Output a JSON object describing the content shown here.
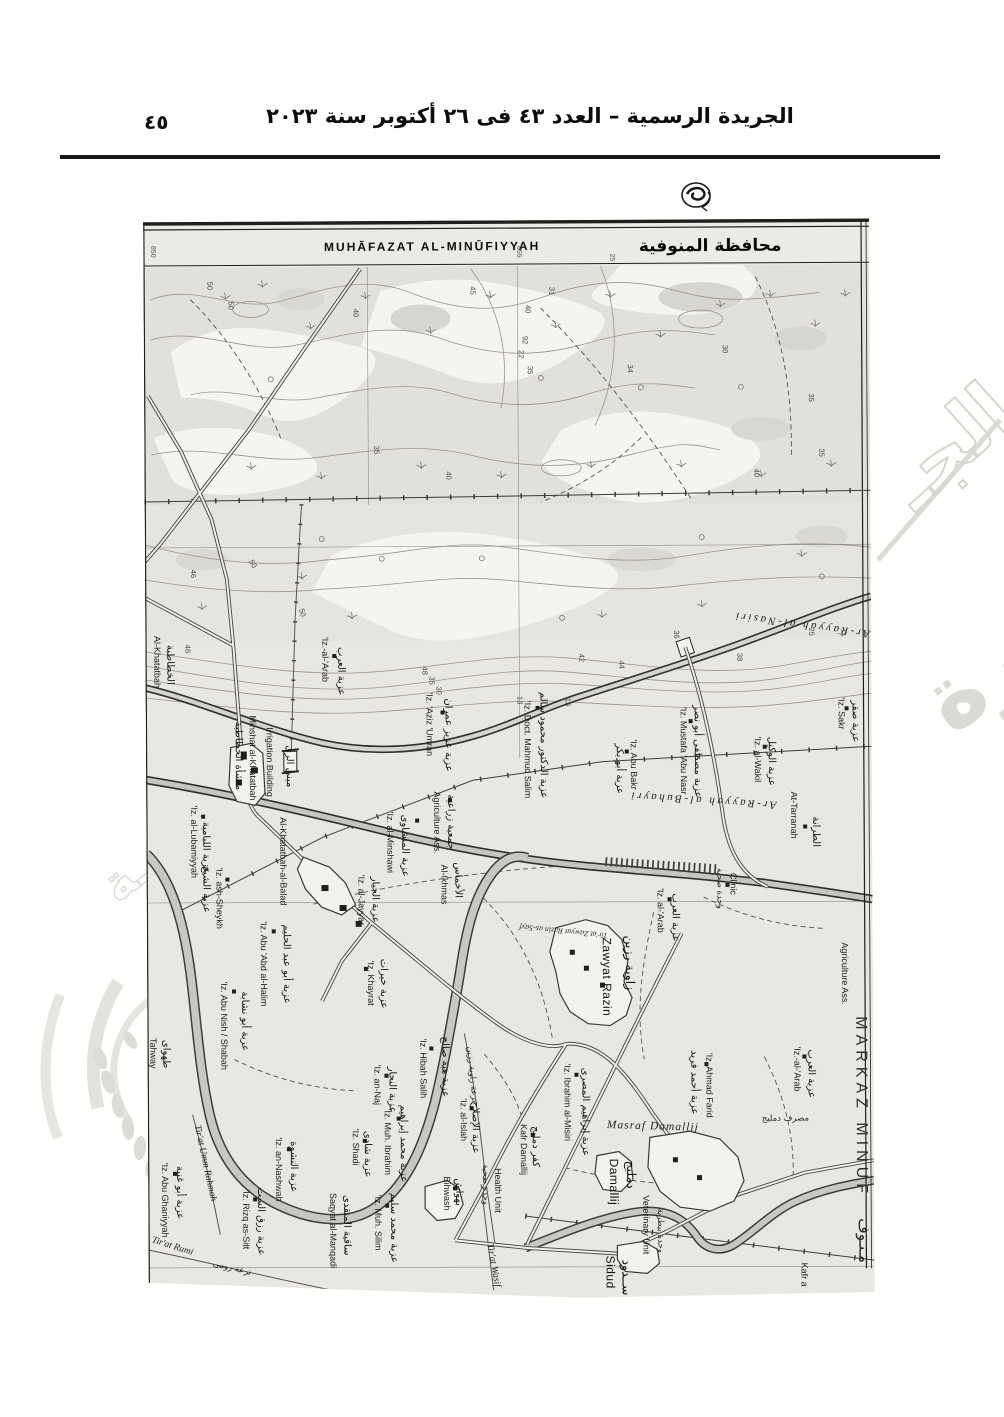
{
  "header": {
    "page_number": "٤٥",
    "gazette_title": "الجريدة الرسمية – العدد ٤٣ فى ٢٦ أكتوبر سنة ٢٠٢٣"
  },
  "map": {
    "title_latin": "MUHĀFAZAT AL-MINŪFIYYAH",
    "title_arabic": "محافظة المنوفية",
    "labels": [
      {
        "t": "850",
        "x": 151,
        "y": 246,
        "r": 90,
        "c": "grid"
      },
      {
        "t": "855",
        "x": 517,
        "y": 248,
        "r": 90,
        "c": "grid"
      },
      {
        "t": "25",
        "x": 610,
        "y": 256,
        "r": 90,
        "c": "grid"
      },
      {
        "t": "50",
        "x": 207,
        "y": 282,
        "r": 90,
        "c": "num"
      },
      {
        "t": "50",
        "x": 228,
        "y": 302,
        "r": 90,
        "c": "num"
      },
      {
        "t": "40",
        "x": 353,
        "y": 310,
        "r": 90,
        "c": "num"
      },
      {
        "t": "35",
        "x": 373,
        "y": 447,
        "r": 90,
        "c": "num"
      },
      {
        "t": "40",
        "x": 445,
        "y": 473,
        "r": 90,
        "c": "num"
      },
      {
        "t": "45",
        "x": 470,
        "y": 288,
        "r": 90,
        "c": "num"
      },
      {
        "t": "40",
        "x": 525,
        "y": 307,
        "r": 90,
        "c": "num"
      },
      {
        "t": "31",
        "x": 549,
        "y": 289,
        "r": 90,
        "c": "num"
      },
      {
        "t": "92",
        "x": 522,
        "y": 338,
        "r": 90,
        "c": "num"
      },
      {
        "t": "22",
        "x": 518,
        "y": 352,
        "r": 90,
        "c": "num"
      },
      {
        "t": "35",
        "x": 527,
        "y": 368,
        "r": 90,
        "c": "num"
      },
      {
        "t": "30",
        "x": 722,
        "y": 348,
        "r": 90,
        "c": "num"
      },
      {
        "t": "34",
        "x": 627,
        "y": 367,
        "r": 90,
        "c": "num"
      },
      {
        "t": "35",
        "x": 808,
        "y": 397,
        "r": 90,
        "c": "num"
      },
      {
        "t": "40",
        "x": 753,
        "y": 472,
        "r": 90,
        "c": "num"
      },
      {
        "t": "35",
        "x": 818,
        "y": 452,
        "r": 90,
        "c": "num"
      },
      {
        "t": "46",
        "x": 189,
        "y": 570,
        "r": 90,
        "c": "num"
      },
      {
        "t": "50",
        "x": 247,
        "y": 562,
        "r": 60,
        "c": "num"
      },
      {
        "t": "50",
        "x": 297,
        "y": 610,
        "r": 75,
        "c": "num"
      },
      {
        "t": "46",
        "x": 183,
        "y": 645,
        "r": 90,
        "c": "num"
      },
      {
        "t": "48",
        "x": 420,
        "y": 668,
        "r": 90,
        "c": "num"
      },
      {
        "t": "35",
        "x": 427,
        "y": 678,
        "r": 90,
        "c": "num"
      },
      {
        "t": "30",
        "x": 434,
        "y": 688,
        "r": 90,
        "c": "num"
      },
      {
        "t": "36",
        "x": 672,
        "y": 633,
        "r": 90,
        "c": "num"
      },
      {
        "t": "25",
        "x": 807,
        "y": 631,
        "r": 90,
        "c": "num"
      },
      {
        "t": "38",
        "x": 735,
        "y": 656,
        "r": 90,
        "c": "num"
      },
      {
        "t": "42",
        "x": 577,
        "y": 656,
        "r": 90,
        "c": "num"
      },
      {
        "t": "44",
        "x": 617,
        "y": 663,
        "r": 90,
        "c": "num"
      },
      {
        "t": "13",
        "x": 515,
        "y": 698,
        "r": 90,
        "c": "num"
      },
      {
        "t": "13",
        "x": 563,
        "y": 700,
        "r": 90,
        "c": "num"
      },
      {
        "t": "Al-Khatatbah",
        "x": 152,
        "y": 636,
        "r": 90,
        "c": "en"
      },
      {
        "t": "الخطاطبة",
        "x": 165,
        "y": 645,
        "r": 90,
        "c": "ar"
      },
      {
        "t": "Minshat al-Khatatbah",
        "x": 247,
        "y": 716,
        "r": 90,
        "c": "en"
      },
      {
        "t": "منشأة الخطاطبة",
        "x": 233,
        "y": 722,
        "r": 90,
        "c": "ar"
      },
      {
        "t": "Irrigation Building",
        "x": 264,
        "y": 728,
        "r": 90,
        "c": "en"
      },
      {
        "t": "مبنى الرى",
        "x": 284,
        "y": 746,
        "r": 90,
        "c": "ar"
      },
      {
        "t": "'Iz.-al-'Arab",
        "x": 320,
        "y": 638,
        "r": 90,
        "c": "en"
      },
      {
        "t": "عزبة العرب",
        "x": 336,
        "y": 648,
        "r": 90,
        "c": "ar"
      },
      {
        "t": "'Iz. 'Aziz 'Umran",
        "x": 424,
        "y": 694,
        "r": 90,
        "c": "en"
      },
      {
        "t": "عزبة عزيز عمران",
        "x": 443,
        "y": 700,
        "r": 90,
        "c": "ar"
      },
      {
        "t": "'Iz. Doct. Mahmud Salim",
        "x": 522,
        "y": 703,
        "r": 90,
        "c": "en"
      },
      {
        "t": "عزبة الدكتور محمود سالم",
        "x": 538,
        "y": 694,
        "r": 90,
        "c": "ar"
      },
      {
        "t": "'Iz. Abu Bakr",
        "x": 628,
        "y": 742,
        "r": 90,
        "c": "en"
      },
      {
        "t": "عزبة أبو بكر",
        "x": 614,
        "y": 746,
        "r": 90,
        "c": "ar"
      },
      {
        "t": "'Iz. Mustafa 'Abu Nasr",
        "x": 678,
        "y": 710,
        "r": 90,
        "c": "en"
      },
      {
        "t": "عزبة مصطفى أبو نصر",
        "x": 692,
        "y": 708,
        "r": 90,
        "c": "ar"
      },
      {
        "t": "'Iz. al-Wakil",
        "x": 752,
        "y": 740,
        "r": 90,
        "c": "en"
      },
      {
        "t": "عزبة الوكيل",
        "x": 766,
        "y": 740,
        "r": 90,
        "c": "ar"
      },
      {
        "t": "'Iz. Sakr",
        "x": 836,
        "y": 701,
        "r": 90,
        "c": "en"
      },
      {
        "t": "عزبة صقر",
        "x": 850,
        "y": 704,
        "r": 90,
        "c": "ar"
      },
      {
        "t": "Ar-Rayyah al-Nasiri",
        "x": 800,
        "y": 625,
        "r": 188,
        "c": "canal",
        "a": "middle"
      },
      {
        "t": "Ar-Rayyah al-Buhayri",
        "x": 700,
        "y": 800,
        "r": 184,
        "c": "canal",
        "a": "middle"
      },
      {
        "t": "At-Tarranah",
        "x": 788,
        "y": 795,
        "r": 90,
        "c": "en"
      },
      {
        "t": "الطرانة",
        "x": 810,
        "y": 820,
        "r": 90,
        "c": "ar"
      },
      {
        "t": "Clinic",
        "x": 727,
        "y": 876,
        "r": 90,
        "c": "en"
      },
      {
        "t": "وحدة صحية",
        "x": 714,
        "y": 871,
        "r": 90,
        "c": "ar-sm"
      },
      {
        "t": "'Iz. al-'Arab",
        "x": 654,
        "y": 891,
        "r": 90,
        "c": "en"
      },
      {
        "t": "عزبة العرب",
        "x": 669,
        "y": 896,
        "r": 90,
        "c": "ar"
      },
      {
        "t": "Zawyat Razin",
        "x": 599,
        "y": 940,
        "r": 90,
        "c": "en-lg"
      },
      {
        "t": "زاوية رزين",
        "x": 622,
        "y": 938,
        "r": 90,
        "c": "ar-lg"
      },
      {
        "t": "'Iz. Ahmad Farid",
        "x": 702,
        "y": 1056,
        "r": 90,
        "c": "en"
      },
      {
        "t": "عزبة أحمد فريد",
        "x": 687,
        "y": 1053,
        "r": 90,
        "c": "ar"
      },
      {
        "t": "'Iz.-al-'Arab",
        "x": 790,
        "y": 1050,
        "r": 90,
        "c": "en"
      },
      {
        "t": "عزبة العرب",
        "x": 804,
        "y": 1053,
        "r": 90,
        "c": "ar"
      },
      {
        "t": "Agriculture Ass.",
        "x": 838,
        "y": 946,
        "r": 90,
        "c": "en"
      },
      {
        "t": "MARKAZ MINUF",
        "x": 852,
        "y": 1020,
        "r": 90,
        "c": "big"
      },
      {
        "t": "مـنـوف",
        "x": 854,
        "y": 1222,
        "r": 90,
        "c": "big-ar"
      },
      {
        "t": "Kafr a",
        "x": 796,
        "y": 1266,
        "r": 90,
        "c": "en"
      },
      {
        "t": "Agriculture Ass.",
        "x": 431,
        "y": 793,
        "r": 90,
        "c": "en"
      },
      {
        "t": "جمعية زراعية",
        "x": 445,
        "y": 796,
        "r": 90,
        "c": "ar"
      },
      {
        "t": "'Iz. al-Minshawi",
        "x": 384,
        "y": 813,
        "r": 90,
        "c": "en"
      },
      {
        "t": "عزبة المنشاوى",
        "x": 399,
        "y": 816,
        "r": 90,
        "c": "ar"
      },
      {
        "t": "Al-Ikhmas",
        "x": 438,
        "y": 866,
        "r": 90,
        "c": "en"
      },
      {
        "t": "الأخماس",
        "x": 452,
        "y": 864,
        "r": 90,
        "c": "ar"
      },
      {
        "t": "'Iz. al-Jayyar",
        "x": 355,
        "y": 876,
        "r": 90,
        "c": "en"
      },
      {
        "t": "عزبة الجيار",
        "x": 369,
        "y": 878,
        "r": 90,
        "c": "ar"
      },
      {
        "t": "Al-Khatatbah-al-Balad",
        "x": 277,
        "y": 818,
        "r": 90,
        "c": "en"
      },
      {
        "t": "'Iz. ash-Sheykh",
        "x": 213,
        "y": 868,
        "r": 90,
        "c": "en"
      },
      {
        "t": "عزبة الشيخ",
        "x": 200,
        "y": 866,
        "r": 90,
        "c": "ar"
      },
      {
        "t": "'Iz. al-Lubamiyyah",
        "x": 188,
        "y": 806,
        "r": 90,
        "c": "en"
      },
      {
        "t": "عزبة اللبامية",
        "x": 200,
        "y": 822,
        "r": 90,
        "c": "ar"
      },
      {
        "t": "'Iz. Abu 'Abd al-Halim",
        "x": 257,
        "y": 922,
        "r": 90,
        "c": "en"
      },
      {
        "t": "عزبة أبو عبد الحليم",
        "x": 280,
        "y": 925,
        "r": 90,
        "c": "ar"
      },
      {
        "t": "'Iz. Abu Nish / Shabah",
        "x": 217,
        "y": 982,
        "r": 90,
        "c": "en"
      },
      {
        "t": "عزبة أبو نشابة",
        "x": 238,
        "y": 992,
        "r": 90,
        "c": "ar"
      },
      {
        "t": "'Iz. Khayrat",
        "x": 364,
        "y": 962,
        "r": 90,
        "c": "en"
      },
      {
        "t": "عزبة خيرات",
        "x": 377,
        "y": 960,
        "r": 90,
        "c": "ar"
      },
      {
        "t": "Tahway",
        "x": 146,
        "y": 1038,
        "r": 90,
        "c": "en"
      },
      {
        "t": "طهواى",
        "x": 159,
        "y": 1040,
        "r": 90,
        "c": "ar"
      },
      {
        "t": "'Iz. Hibah Salih",
        "x": 416,
        "y": 1040,
        "r": 90,
        "c": "en"
      },
      {
        "t": "عزبة هبة صالح",
        "x": 438,
        "y": 1038,
        "r": 90,
        "c": "ar"
      },
      {
        "t": "'Iz. an-Naj",
        "x": 370,
        "y": 1066,
        "r": 90,
        "c": "en"
      },
      {
        "t": "عزبة النجار",
        "x": 385,
        "y": 1068,
        "r": 90,
        "c": "ar"
      },
      {
        "t": "'Iz. Muh. Ibrahim",
        "x": 380,
        "y": 1110,
        "r": 90,
        "c": "en"
      },
      {
        "t": "عزبة محمد إبراهيم",
        "x": 396,
        "y": 1106,
        "r": 90,
        "c": "ar"
      },
      {
        "t": "'Iz. Shadi",
        "x": 348,
        "y": 1130,
        "r": 90,
        "c": "en"
      },
      {
        "t": "عزبة شادى",
        "x": 360,
        "y": 1132,
        "r": 90,
        "c": "ar"
      },
      {
        "t": "'Iz. Muh. Silim",
        "x": 370,
        "y": 1196,
        "r": 90,
        "c": "en"
      },
      {
        "t": "عزبة محمد سليم",
        "x": 386,
        "y": 1194,
        "r": 90,
        "c": "ar"
      },
      {
        "t": "Saqyat al-Manqadi",
        "x": 325,
        "y": 1194,
        "r": 90,
        "c": "en"
      },
      {
        "t": "ساقية المنقدى",
        "x": 339,
        "y": 1196,
        "r": 90,
        "c": "ar"
      },
      {
        "t": "'Iz. Rizq as-Sitt",
        "x": 238,
        "y": 1190,
        "r": 90,
        "c": "en"
      },
      {
        "t": "عزبة رزق الست",
        "x": 253,
        "y": 1188,
        "r": 90,
        "c": "ar"
      },
      {
        "t": "'Iz. Abu Ghaniyyah",
        "x": 157,
        "y": 1163,
        "r": 90,
        "c": "en"
      },
      {
        "t": "عزبة أبو غنية",
        "x": 172,
        "y": 1166,
        "r": 90,
        "c": "ar"
      },
      {
        "t": "'Iz. an-Nashwah",
        "x": 271,
        "y": 1138,
        "r": 90,
        "c": "en"
      },
      {
        "t": "عزبة النشوة",
        "x": 286,
        "y": 1142,
        "r": 90,
        "c": "ar"
      },
      {
        "t": "Bihwash",
        "x": 439,
        "y": 1178,
        "r": 90,
        "c": "en"
      },
      {
        "t": "بهواش",
        "x": 451,
        "y": 1180,
        "r": 90,
        "c": "ar"
      },
      {
        "t": "Health Unit",
        "x": 490,
        "y": 1170,
        "r": 90,
        "c": "en"
      },
      {
        "t": "وحدة صحية",
        "x": 478,
        "y": 1166,
        "r": 90,
        "c": "ar-sm"
      },
      {
        "t": "'Iz. al-Islah",
        "x": 456,
        "y": 1100,
        "r": 90,
        "c": "en"
      },
      {
        "t": "عزبة الإصلاح",
        "x": 468,
        "y": 1103,
        "r": 90,
        "c": "ar"
      },
      {
        "t": "Kafr Damallij",
        "x": 516,
        "y": 1126,
        "r": 90,
        "c": "en"
      },
      {
        "t": "كفر دمليج",
        "x": 528,
        "y": 1128,
        "r": 90,
        "c": "ar"
      },
      {
        "t": "'Iz. Ibrahim al-Misiri",
        "x": 560,
        "y": 1066,
        "r": 90,
        "c": "en"
      },
      {
        "t": "عزبة إبراهيم المصرى",
        "x": 578,
        "y": 1070,
        "r": 90,
        "c": "ar"
      },
      {
        "t": "Damallij",
        "x": 605,
        "y": 1161,
        "r": 90,
        "c": "en-lg"
      },
      {
        "t": "دمليج",
        "x": 622,
        "y": 1163,
        "r": 90,
        "c": "ar-lg"
      },
      {
        "t": "Veterinary Unit",
        "x": 638,
        "y": 1198,
        "r": 90,
        "c": "en"
      },
      {
        "t": "وحدة بيطرية",
        "x": 653,
        "y": 1211,
        "r": 90,
        "c": "ar-sm"
      },
      {
        "t": "Sidud",
        "x": 601,
        "y": 1258,
        "r": 90,
        "c": "en-lg"
      },
      {
        "t": "ســدود",
        "x": 617,
        "y": 1262,
        "r": 90,
        "c": "ar-lg"
      },
      {
        "t": "Masraf Damallij",
        "x": 648,
        "y": 1132,
        "r": 2,
        "c": "it-lg",
        "a": "middle"
      },
      {
        "t": "مصرف دمليج",
        "x": 757,
        "y": 1124,
        "r": 0,
        "c": "ar-sm"
      },
      {
        "t": "Tir'at Umm Rahmah",
        "x": 190,
        "y": 1126,
        "r": 78,
        "c": "it"
      },
      {
        "t": "Tir'at Rumi",
        "x": 146,
        "y": 1242,
        "r": 18,
        "c": "it"
      },
      {
        "t": "ترعة رومى",
        "x": 207,
        "y": 1266,
        "r": 14,
        "c": "ar-sm"
      },
      {
        "t": "Tir'at Wasif",
        "x": 482,
        "y": 1246,
        "r": 80,
        "c": "it"
      },
      {
        "t": "Tir'at Zawyat Razin as-Sayf",
        "x": 560,
        "y": 931,
        "r": 186,
        "c": "it-sm",
        "a": "middle"
      },
      {
        "t": "ترعة زاوية رزين",
        "x": 463,
        "y": 1048,
        "r": 85,
        "c": "ar-sm"
      }
    ]
  },
  "watermark": {
    "fragments": [
      {
        "t": "صورة",
        "x": 952,
        "y": 736,
        "r": -38,
        "c": "fill"
      },
      {
        "t": "الجـ",
        "x": 916,
        "y": 512,
        "r": -42,
        "c": "outline"
      },
      {
        "t": "ـة",
        "x": 118,
        "y": 905,
        "r": -40,
        "c": "outline-sm"
      }
    ]
  }
}
